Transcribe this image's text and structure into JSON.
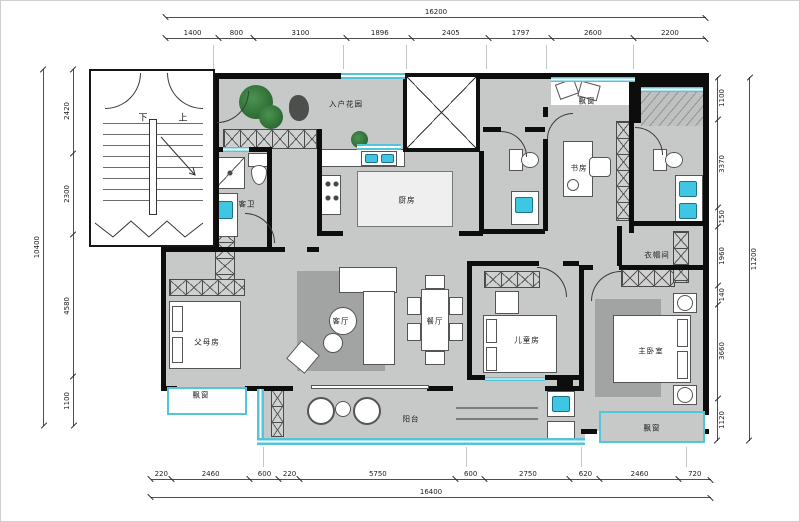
{
  "drawing": {
    "rooms": {
      "entry_garden": "入户花园",
      "kitchen": "厨房",
      "guest_bath": "客卫",
      "study": "书房",
      "cloakroom": "衣帽间",
      "parents_room": "父母房",
      "living_room": "客厅",
      "dining_room": "餐厅",
      "children_room": "儿童房",
      "master_bedroom": "主卧室",
      "balcony": "阳台",
      "bay_window": "飘窗",
      "stair_down": "下",
      "stair_up": "上"
    },
    "colors": {
      "wall": "#0d0d0d",
      "floor": "#c7c9c8",
      "window": "#52c6d8",
      "fixture": "#3fc6e2",
      "rug": "#a2a4a3",
      "plant": "#2c6a33"
    }
  },
  "dimensions": {
    "top": {
      "overall": "16200",
      "segments": [
        "1400",
        "800",
        "3100",
        "1896",
        "2405",
        "1797",
        "2600",
        "2200"
      ]
    },
    "bottom": {
      "overall": "16400",
      "segments": [
        "220",
        "2460",
        "600",
        "220",
        "5750",
        "600",
        "2750",
        "620",
        "2460",
        "720"
      ]
    },
    "left": {
      "overall": "10400",
      "segments": [
        "2420",
        "2300",
        "4580",
        "1100"
      ]
    },
    "right": {
      "overall": "11200",
      "segments": [
        "1100",
        "3370",
        "150",
        "1960",
        "140",
        "3660",
        "1120"
      ]
    }
  }
}
